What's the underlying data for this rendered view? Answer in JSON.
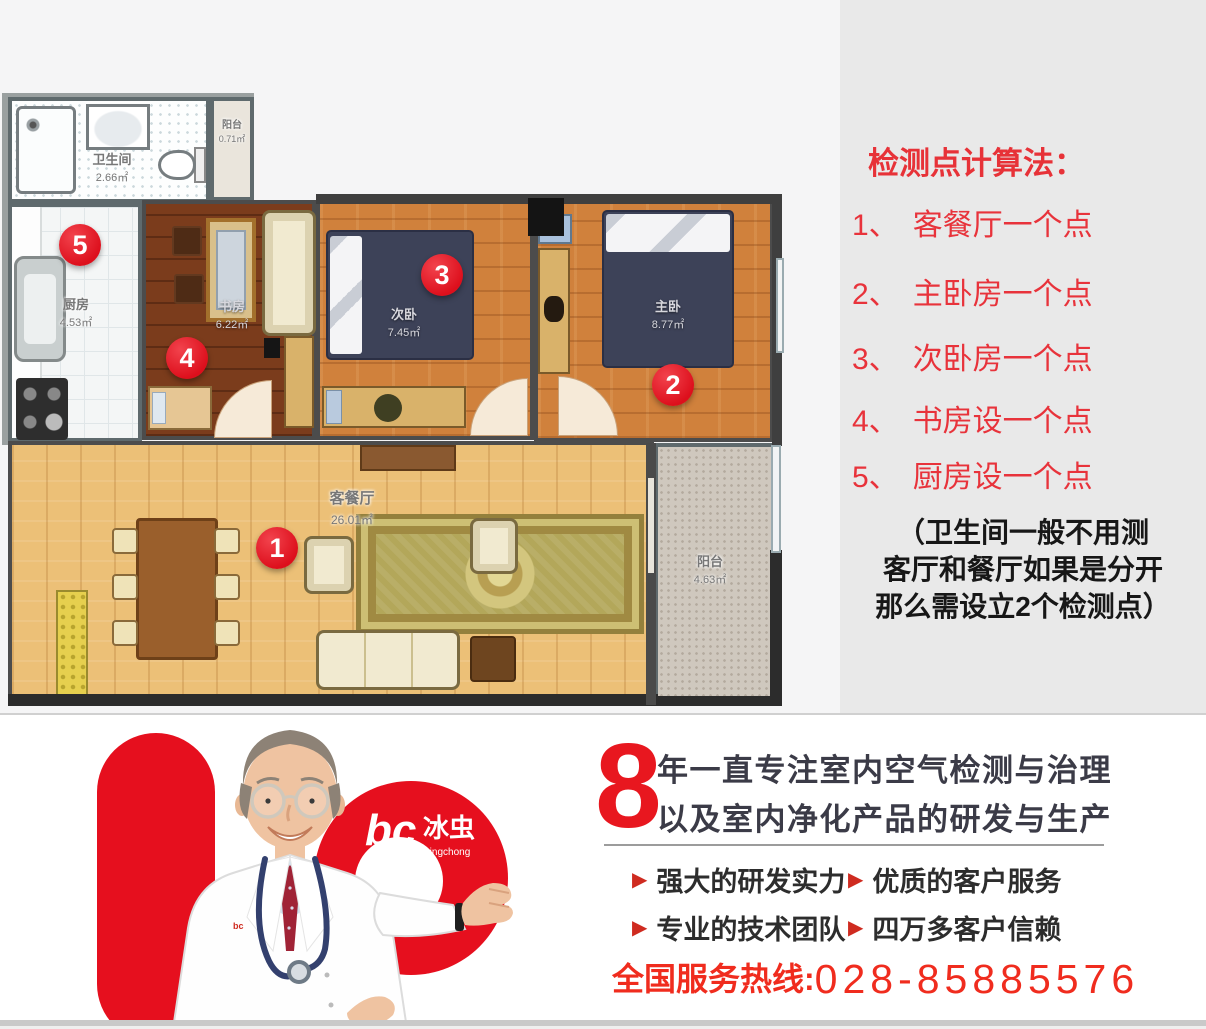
{
  "plan": {
    "rooms": {
      "bathroom": {
        "name": "卫生间",
        "area": "2.66㎡"
      },
      "balcony_top": {
        "name": "阳台",
        "area": "0.71㎡"
      },
      "kitchen": {
        "name": "厨房",
        "area": "4.53㎡"
      },
      "study": {
        "name": "书房",
        "area": "6.22㎡"
      },
      "second_bedroom": {
        "name": "次卧",
        "area": "7.45㎡"
      },
      "master_bedroom": {
        "name": "主卧",
        "area": "8.77㎡"
      },
      "living_dining": {
        "name": "客餐厅",
        "area": "26.01㎡"
      },
      "balcony_bottom": {
        "name": "阳台",
        "area": "4.63㎡"
      }
    },
    "markers": [
      "1",
      "2",
      "3",
      "4",
      "5"
    ]
  },
  "panel": {
    "title": "检测点计算法：",
    "items": [
      {
        "num": "1、",
        "label": "客餐厅一个点"
      },
      {
        "num": "2、",
        "label": "主卧房一个点"
      },
      {
        "num": "3、",
        "label": "次卧房一个点"
      },
      {
        "num": "4、",
        "label": "书房设一个点"
      },
      {
        "num": "5、",
        "label": "厨房设一个点"
      }
    ],
    "note_lines": [
      "（卫生间一般不用测",
      "客厅和餐厅如果是分开",
      "那么需设立2个检测点）"
    ]
  },
  "footer": {
    "big_number": "8",
    "headline_line1": "年一直专注室内空气检测与治理",
    "headline_line2": "以及室内净化产品的研发与生产",
    "bullet": "▶",
    "features": [
      "强大的研发实力",
      "优质的客户服务",
      "专业的技术团队",
      "四万多客户信赖"
    ],
    "hotline_label": "全国服务热线:",
    "hotline_number": "028-85885576",
    "logo": {
      "mark": "bc",
      "zh": "冰虫",
      "en": "Bingchong"
    }
  },
  "colors": {
    "accent_red": "#e60f1e",
    "panel_red": "#e8333b",
    "marker_red": "#dd0f1c",
    "headline_dark": "#3b3b47"
  }
}
